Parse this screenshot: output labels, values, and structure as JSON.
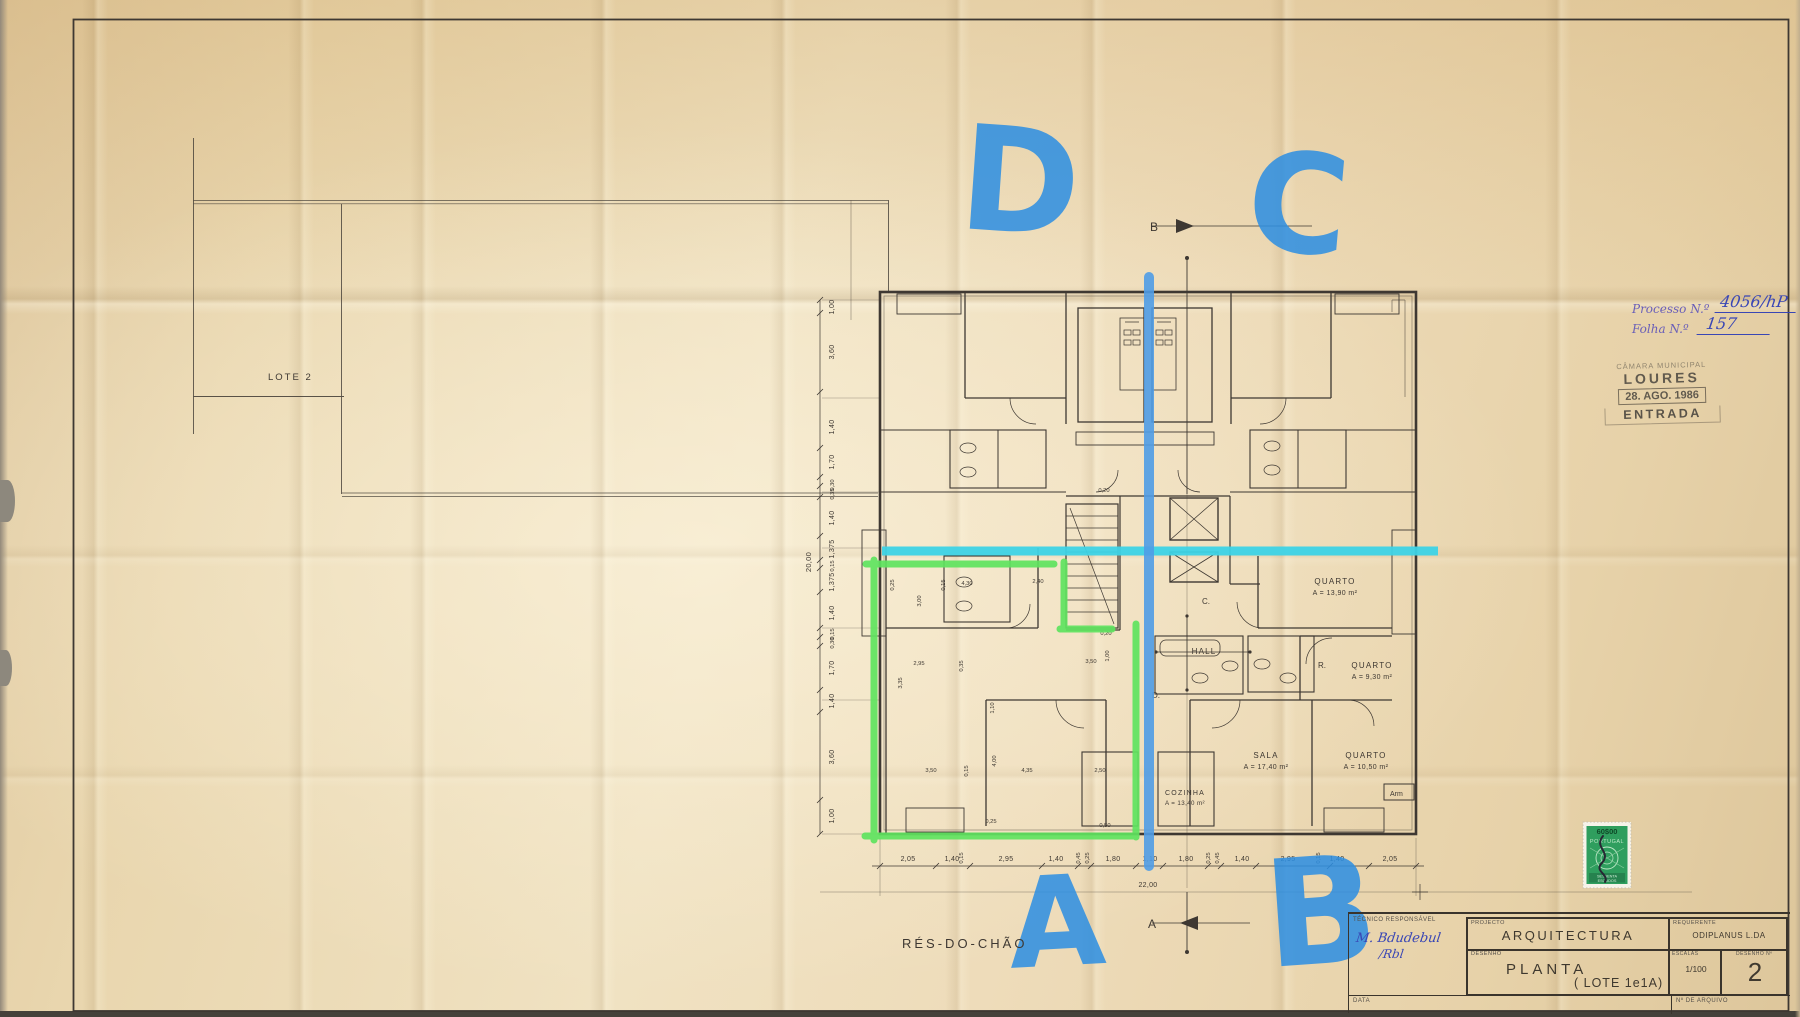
{
  "sheet": {
    "plan_title": "RÉS-DO-CHÃO",
    "lote_label": "LOTE  2"
  },
  "registry": {
    "processo_label": "Processo N.º",
    "processo_value": "4056/hP",
    "folha_label": "Folha N.º",
    "folha_value": "157"
  },
  "entry_stamp": {
    "org": "CÂMARA MUNICIPAL",
    "city": "LOURES",
    "date": "28. AGO. 1986",
    "word": "ENTRADA"
  },
  "tax_stamp": {
    "value": "60$00",
    "country": "PORTUGAL",
    "denom_line1": "SESSENTA",
    "denom_line2": "ESCUDOS"
  },
  "annotations": {
    "letter_d": "D",
    "letter_c": "C",
    "letter_a": "A",
    "letter_b": "B"
  },
  "plan": {
    "rooms": [
      {
        "name": "QUARTO",
        "area": "A = 13,90 m²"
      },
      {
        "name": "QUARTO",
        "area": "A = 9,30 m²"
      },
      {
        "name": "SALA",
        "area": "A = 17,40 m²"
      },
      {
        "name": "QUARTO",
        "area": "A = 10,50 m²"
      },
      {
        "name": "COZINHA",
        "area": "A = 13,40 m²"
      }
    ],
    "hall_label": "HALL",
    "closet_label": "Arm",
    "marks": {
      "top": "B",
      "bottom": "A",
      "c": "C.",
      "d": "D.",
      "r": "R."
    },
    "total_width": "22,00",
    "total_height": "20,00",
    "dims_bottom": [
      "2,05",
      "1,40",
      "2,95",
      "1,40",
      "1,80",
      "1,10",
      "1,80",
      "1,40",
      "2,95",
      "1,40",
      "2,05"
    ],
    "dims_bottom_small": [
      "0,15",
      "0,45",
      "0,25",
      "0,25",
      "0,45",
      "0,15"
    ],
    "dims_left": [
      "1,00",
      "3,60",
      "1,40",
      "1,70",
      "0,30",
      "0,35",
      "1,40",
      "1,375",
      "0,15",
      "1,375",
      "1,40",
      "0,15",
      "0,30",
      "1,70",
      "1,40",
      "3,60",
      "1,00"
    ],
    "dims_interior": [
      "4,30",
      "2,40",
      "3,00",
      "0,15",
      "0,25",
      "2,95",
      "0,35",
      "3,35",
      "3,50",
      "0,20",
      "1,00",
      "3,50",
      "4,00",
      "4,35",
      "0,15",
      "2,50",
      "0,25",
      "0,50",
      "1,10",
      "0,20"
    ]
  },
  "title_block": {
    "tecnico_label": "TÉCNICO RESPONSÁVEL",
    "projecto_label": "PROJECTO",
    "projecto_value": "ARQUITECTURA",
    "requerente_label": "REQUERENTE",
    "requerente_value": "ODIPLANUS  L.DA",
    "desenho_label": "DESENHO",
    "desenho_value": "PLANTA",
    "desenho_lote": "( LOTE  1e1A)",
    "escalas_label": "ESCALAS",
    "escalas_value": "1/100",
    "numero_label": "DESENHO Nº",
    "numero_value": "2",
    "arquivo_label": "Nº DE ARQUIVO",
    "data_label": "DATA"
  },
  "signature": {
    "line1": "M. Bdudebul",
    "line2": "/Rbl"
  }
}
